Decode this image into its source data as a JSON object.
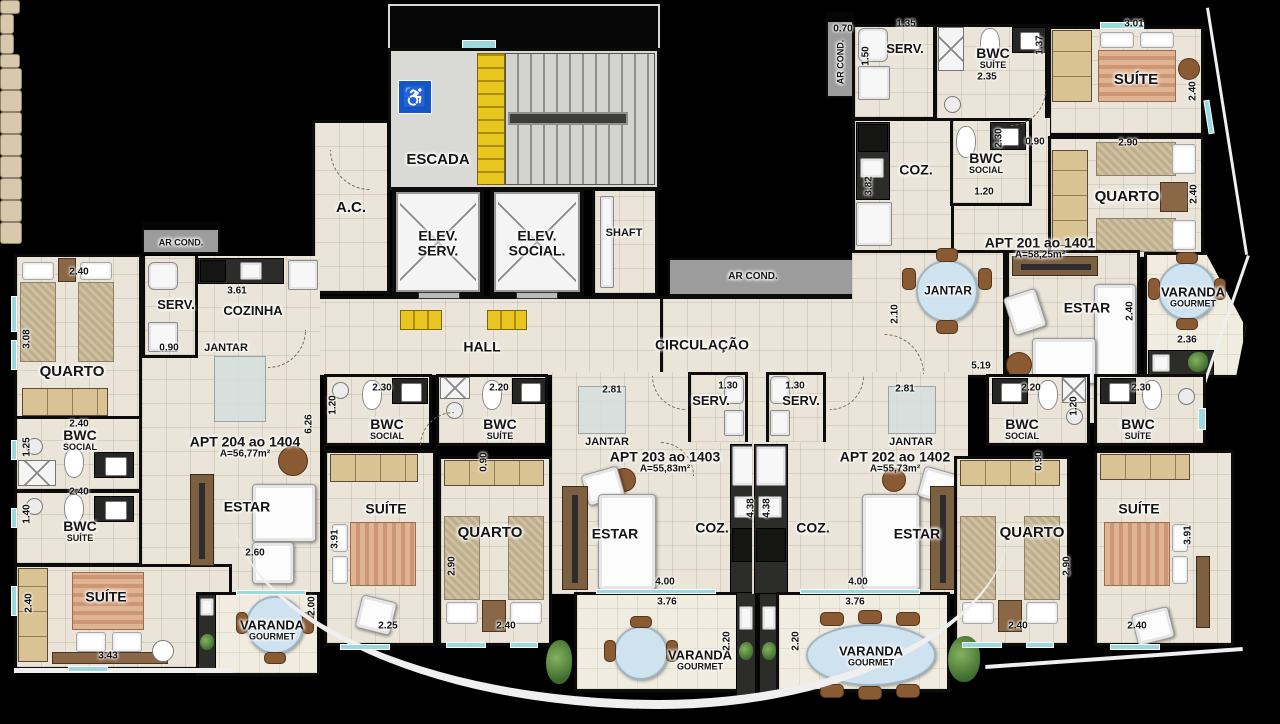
{
  "icons": {
    "wheelchair": "♿"
  },
  "colors": {
    "accent_yellow": "#e9c61f",
    "wall": "#0c0c0c",
    "floor": "#eae5d8",
    "granite": "#2c2c29",
    "table_blue": "#cfe2ef",
    "access_blue": "#1257c9"
  },
  "apartments": {
    "a201": {
      "name": "APT 201 ao 1401",
      "area": "A=58,25m²"
    },
    "a202": {
      "name": "APT 202 ao 1402",
      "area": "A=55,73m²"
    },
    "a203": {
      "name": "APT 203 ao 1403",
      "area": "A=55,83m²"
    },
    "a204": {
      "name": "APT 204 ao 1404",
      "area": "A=56,77m²"
    }
  },
  "plan_labels": [
    {
      "id": "escada-label",
      "t": "ESCADA",
      "fs": 15,
      "x": 438,
      "y": 160
    },
    {
      "id": "ac-label",
      "t": "A.C.",
      "fs": 15,
      "x": 351,
      "y": 208
    },
    {
      "id": "elev-serv-label",
      "t": "ELEV.",
      "s": "SERV.",
      "fs": 14,
      "ss": 14,
      "x": 438,
      "y": 243
    },
    {
      "id": "elev-social-label",
      "t": "ELEV.",
      "s": "SOCIAL.",
      "fs": 14,
      "ss": 14,
      "x": 537,
      "y": 243
    },
    {
      "id": "shaft-label",
      "t": "SHAFT",
      "fs": 11,
      "x": 624,
      "y": 234
    },
    {
      "id": "hall-label",
      "t": "HALL",
      "fs": 14,
      "x": 482,
      "y": 347
    },
    {
      "id": "circulacao-label",
      "t": "CIRCULAÇÃO",
      "fs": 14,
      "x": 702,
      "y": 345
    },
    {
      "id": "arcond-mid-label",
      "t": "AR COND.",
      "fs": 10,
      "x": 753,
      "y": 277
    },
    {
      "id": "arcond-left-label",
      "t": "AR COND.",
      "fs": 9,
      "x": 181,
      "y": 243
    },
    {
      "id": "arcond-201-label",
      "t": "AR COND.",
      "fs": 9,
      "v": 1,
      "x": 841,
      "y": 62
    },
    {
      "id": "a201-serv-label",
      "t": "SERV.",
      "fs": 13,
      "x": 905,
      "y": 49
    },
    {
      "id": "a201-bwc-suite-label",
      "t": "BWC",
      "s": "SUÍTE",
      "fs": 14,
      "ss": 9,
      "x": 993,
      "y": 58
    },
    {
      "id": "a201-suite-label",
      "t": "SUÍTE",
      "fs": 15,
      "x": 1136,
      "y": 80
    },
    {
      "id": "a201-coz-label",
      "t": "COZ.",
      "fs": 14,
      "x": 916,
      "y": 170
    },
    {
      "id": "a201-bwc-social-label",
      "t": "BWC",
      "s": "SOCIAL",
      "fs": 14,
      "ss": 9,
      "x": 986,
      "y": 163
    },
    {
      "id": "a201-quarto-label",
      "t": "QUARTO",
      "fs": 15,
      "x": 1127,
      "y": 197
    },
    {
      "id": "a201-jantar-label",
      "t": "JANTAR",
      "fs": 12,
      "x": 948,
      "y": 291
    },
    {
      "id": "a201-estar-label",
      "t": "ESTAR",
      "fs": 14,
      "x": 1087,
      "y": 308
    },
    {
      "id": "a201-varanda-label",
      "t": "VARANDA",
      "s": "GOURMET",
      "fs": 13,
      "ss": 9,
      "x": 1193,
      "y": 297
    },
    {
      "id": "a201-name-label",
      "t": "APT 201 ao 1401",
      "s": "A=58,25m²",
      "fs": 14,
      "ss": 10,
      "x": 1040,
      "y": 248
    },
    {
      "id": "a204-serv-label",
      "t": "SERV.",
      "fs": 13,
      "x": 176,
      "y": 305
    },
    {
      "id": "a204-cozinha-label",
      "t": "COZINHA",
      "fs": 13,
      "x": 253,
      "y": 311
    },
    {
      "id": "a204-jantar-label",
      "t": "JANTAR",
      "fs": 11,
      "x": 226,
      "y": 349
    },
    {
      "id": "a204-quarto-label",
      "t": "QUARTO",
      "fs": 15,
      "x": 72,
      "y": 372
    },
    {
      "id": "a204-bwc-social-label",
      "t": "BWC",
      "s": "SOCIAL",
      "fs": 14,
      "ss": 9,
      "x": 80,
      "y": 440
    },
    {
      "id": "a204-bwc-suite-label",
      "t": "BWC",
      "s": "SUÍTE",
      "fs": 14,
      "ss": 9,
      "x": 80,
      "y": 531
    },
    {
      "id": "a204-suite-label",
      "t": "SUÍTE",
      "fs": 14,
      "x": 106,
      "y": 597
    },
    {
      "id": "a204-estar-label",
      "t": "ESTAR",
      "fs": 14,
      "x": 247,
      "y": 507
    },
    {
      "id": "a204-varanda-label",
      "t": "VARANDA",
      "s": "GOURMET",
      "fs": 13,
      "ss": 9,
      "x": 272,
      "y": 630
    },
    {
      "id": "a204-name-label",
      "t": "APT 204 ao 1404",
      "s": "A=56,77m²",
      "fs": 14,
      "ss": 10,
      "x": 245,
      "y": 447
    },
    {
      "id": "a203-bwc-social-label",
      "t": "BWC",
      "s": "SOCIAL",
      "fs": 14,
      "ss": 9,
      "x": 387,
      "y": 429
    },
    {
      "id": "a203-bwc-suite-label",
      "t": "BWC",
      "s": "SUÍTE",
      "fs": 14,
      "ss": 9,
      "x": 500,
      "y": 429
    },
    {
      "id": "a203-suite-label",
      "t": "SUÍTE",
      "fs": 14,
      "x": 386,
      "y": 509
    },
    {
      "id": "a203-quarto-label",
      "t": "QUARTO",
      "fs": 15,
      "x": 490,
      "y": 533
    },
    {
      "id": "a203-jantar-label",
      "t": "JANTAR",
      "fs": 11,
      "x": 607,
      "y": 443
    },
    {
      "id": "a203-serv-label",
      "t": "SERV.",
      "fs": 13,
      "x": 711,
      "y": 401
    },
    {
      "id": "a203-coz-label",
      "t": "COZ.",
      "fs": 14,
      "x": 712,
      "y": 528
    },
    {
      "id": "a203-estar-label",
      "t": "ESTAR",
      "fs": 14,
      "x": 615,
      "y": 534
    },
    {
      "id": "a203-varanda-label",
      "t": "VARANDA",
      "s": "GOURMET",
      "fs": 13,
      "ss": 9,
      "x": 700,
      "y": 660
    },
    {
      "id": "a203-name-label",
      "t": "APT 203 ao 1403",
      "s": "A=55,83m²",
      "fs": 14,
      "ss": 10,
      "x": 665,
      "y": 462
    },
    {
      "id": "a202-serv-label",
      "t": "SERV.",
      "fs": 13,
      "x": 801,
      "y": 401
    },
    {
      "id": "a202-jantar-label",
      "t": "JANTAR",
      "fs": 11,
      "x": 911,
      "y": 443
    },
    {
      "id": "a202-coz-label",
      "t": "COZ.",
      "fs": 14,
      "x": 813,
      "y": 528
    },
    {
      "id": "a202-estar-label",
      "t": "ESTAR",
      "fs": 14,
      "x": 917,
      "y": 534
    },
    {
      "id": "a202-bwc-social-label",
      "t": "BWC",
      "s": "SOCIAL",
      "fs": 14,
      "ss": 9,
      "x": 1022,
      "y": 429
    },
    {
      "id": "a202-bwc-suite-label",
      "t": "BWC",
      "s": "SUÍTE",
      "fs": 14,
      "ss": 9,
      "x": 1138,
      "y": 429
    },
    {
      "id": "a202-quarto-label",
      "t": "QUARTO",
      "fs": 15,
      "x": 1032,
      "y": 533
    },
    {
      "id": "a202-suite-label",
      "t": "SUÍTE",
      "fs": 14,
      "x": 1139,
      "y": 509
    },
    {
      "id": "a202-varanda-label",
      "t": "VARANDA",
      "s": "GOURMET",
      "fs": 13,
      "ss": 9,
      "x": 871,
      "y": 656
    },
    {
      "id": "a202-name-label",
      "t": "APT 202 ao 1402",
      "s": "A=55,73m²",
      "fs": 14,
      "ss": 10,
      "x": 895,
      "y": 462
    }
  ],
  "dims": [
    {
      "v": "0.70",
      "x": 843,
      "y": 29
    },
    {
      "v": "1.35",
      "x": 906,
      "y": 24
    },
    {
      "v": "1.50",
      "x": 866,
      "y": 56,
      "r": 1
    },
    {
      "v": "2.35",
      "x": 987,
      "y": 77
    },
    {
      "v": "1.37",
      "x": 1040,
      "y": 45,
      "r": 1
    },
    {
      "v": "3.01",
      "x": 1134,
      "y": 24
    },
    {
      "v": "2.40",
      "x": 1193,
      "y": 91,
      "r": 1
    },
    {
      "v": "3.82",
      "x": 869,
      "y": 186,
      "r": 1
    },
    {
      "v": "2.30",
      "x": 999,
      "y": 138,
      "r": 1
    },
    {
      "v": "1.20",
      "x": 984,
      "y": 192
    },
    {
      "v": "0.90",
      "x": 1035,
      "y": 142
    },
    {
      "v": "2.90",
      "x": 1128,
      "y": 143
    },
    {
      "v": "2.40",
      "x": 1194,
      "y": 194,
      "r": 1
    },
    {
      "v": "2.10",
      "x": 895,
      "y": 314,
      "r": 1
    },
    {
      "v": "5.19",
      "x": 981,
      "y": 366
    },
    {
      "v": "2.40",
      "x": 1130,
      "y": 311,
      "r": 1
    },
    {
      "v": "2.36",
      "x": 1187,
      "y": 340
    },
    {
      "v": "2.40",
      "x": 79,
      "y": 272
    },
    {
      "v": "3.08",
      "x": 27,
      "y": 339,
      "r": 1
    },
    {
      "v": "0.90",
      "x": 169,
      "y": 348
    },
    {
      "v": "3.61",
      "x": 237,
      "y": 291
    },
    {
      "v": "6.26",
      "x": 309,
      "y": 424,
      "r": 1
    },
    {
      "v": "2.40",
      "x": 79,
      "y": 424
    },
    {
      "v": "1.25",
      "x": 27,
      "y": 447,
      "r": 1
    },
    {
      "v": "2.40",
      "x": 79,
      "y": 492
    },
    {
      "v": "1.40",
      "x": 27,
      "y": 514,
      "r": 1
    },
    {
      "v": "2.40",
      "x": 29,
      "y": 603,
      "r": 1
    },
    {
      "v": "3.43",
      "x": 108,
      "y": 656
    },
    {
      "v": "2.60",
      "x": 255,
      "y": 553
    },
    {
      "v": "2.00",
      "x": 312,
      "y": 606,
      "r": 1
    },
    {
      "v": "2.30",
      "x": 382,
      "y": 388
    },
    {
      "v": "1.20",
      "x": 333,
      "y": 405,
      "r": 1
    },
    {
      "v": "2.20",
      "x": 499,
      "y": 388
    },
    {
      "v": "0.90",
      "x": 484,
      "y": 462,
      "r": 1
    },
    {
      "v": "3.91",
      "x": 335,
      "y": 539,
      "r": 1
    },
    {
      "v": "2.25",
      "x": 388,
      "y": 626
    },
    {
      "v": "2.90",
      "x": 452,
      "y": 566,
      "r": 1
    },
    {
      "v": "2.40",
      "x": 506,
      "y": 626
    },
    {
      "v": "2.81",
      "x": 612,
      "y": 390
    },
    {
      "v": "1.30",
      "x": 728,
      "y": 386
    },
    {
      "v": "4.38",
      "x": 751,
      "y": 508,
      "r": 1
    },
    {
      "v": "4.00",
      "x": 665,
      "y": 582
    },
    {
      "v": "3.76",
      "x": 667,
      "y": 602
    },
    {
      "v": "2.20",
      "x": 727,
      "y": 641,
      "r": 1
    },
    {
      "v": "1.30",
      "x": 795,
      "y": 386
    },
    {
      "v": "2.81",
      "x": 905,
      "y": 389
    },
    {
      "v": "4.38",
      "x": 767,
      "y": 508,
      "r": 1
    },
    {
      "v": "4.00",
      "x": 858,
      "y": 582
    },
    {
      "v": "2.20",
      "x": 1031,
      "y": 388
    },
    {
      "v": "1.20",
      "x": 1074,
      "y": 406,
      "r": 1
    },
    {
      "v": "2.30",
      "x": 1141,
      "y": 388
    },
    {
      "v": "0.90",
      "x": 1039,
      "y": 461,
      "r": 1
    },
    {
      "v": "2.90",
      "x": 1067,
      "y": 566,
      "r": 1
    },
    {
      "v": "2.40",
      "x": 1018,
      "y": 626
    },
    {
      "v": "3.91",
      "x": 1188,
      "y": 535,
      "r": 1
    },
    {
      "v": "2.40",
      "x": 1137,
      "y": 626
    },
    {
      "v": "3.76",
      "x": 855,
      "y": 602
    },
    {
      "v": "2.20",
      "x": 796,
      "y": 641,
      "r": 1
    }
  ]
}
